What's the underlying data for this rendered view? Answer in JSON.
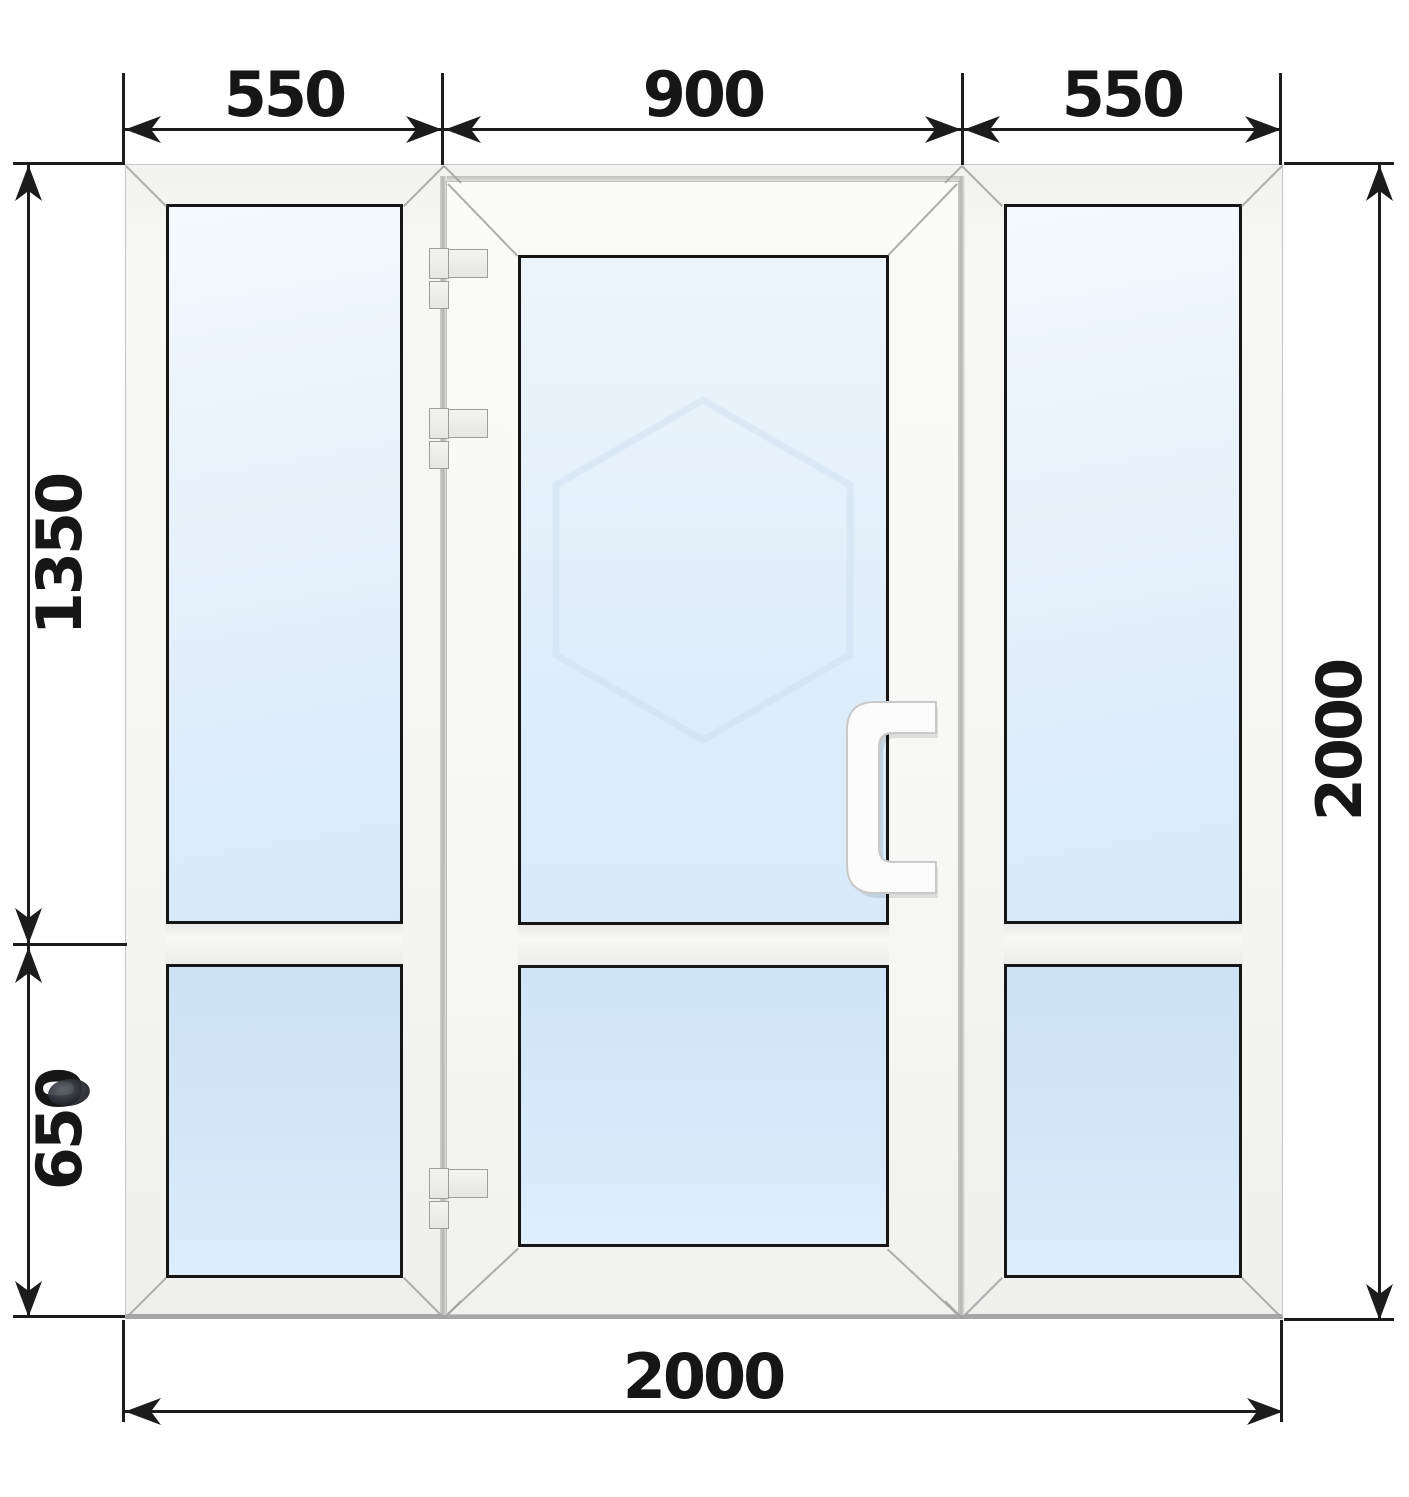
{
  "drawing": {
    "kind": "pvc-entrance-door-with-two-sidelights-dimension-drawing"
  },
  "dimensions": {
    "top_left_width": "550",
    "top_center_width": "900",
    "top_right_width": "550",
    "left_upper_height": "1350",
    "left_lower_height": "650",
    "right_total_height": "2000",
    "bottom_total_width": "2000"
  },
  "colors": {
    "dimension_line": "#1c1c1c",
    "frame_fill": "#f5f5f3",
    "frame_edge": "#a6a6a6",
    "glass_light": "#eef6fd",
    "glass_blue": "#cfe3f6",
    "background": "#ffffff"
  }
}
